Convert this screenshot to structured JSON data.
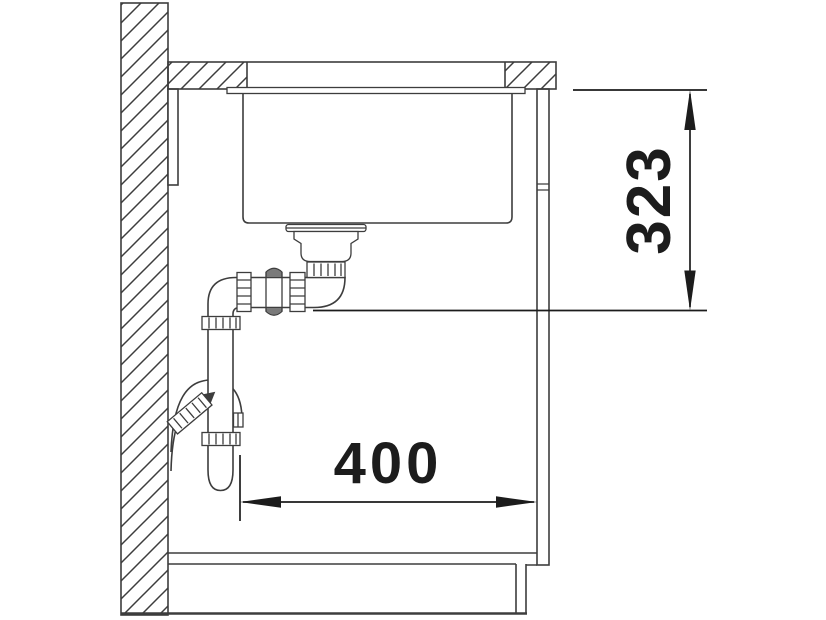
{
  "drawing": {
    "dimension_vertical": "323",
    "dimension_horizontal": "400",
    "colors": {
      "line": "#3d3d3d",
      "dimension_ink": "#1c1c1c",
      "background": "#ffffff"
    }
  }
}
